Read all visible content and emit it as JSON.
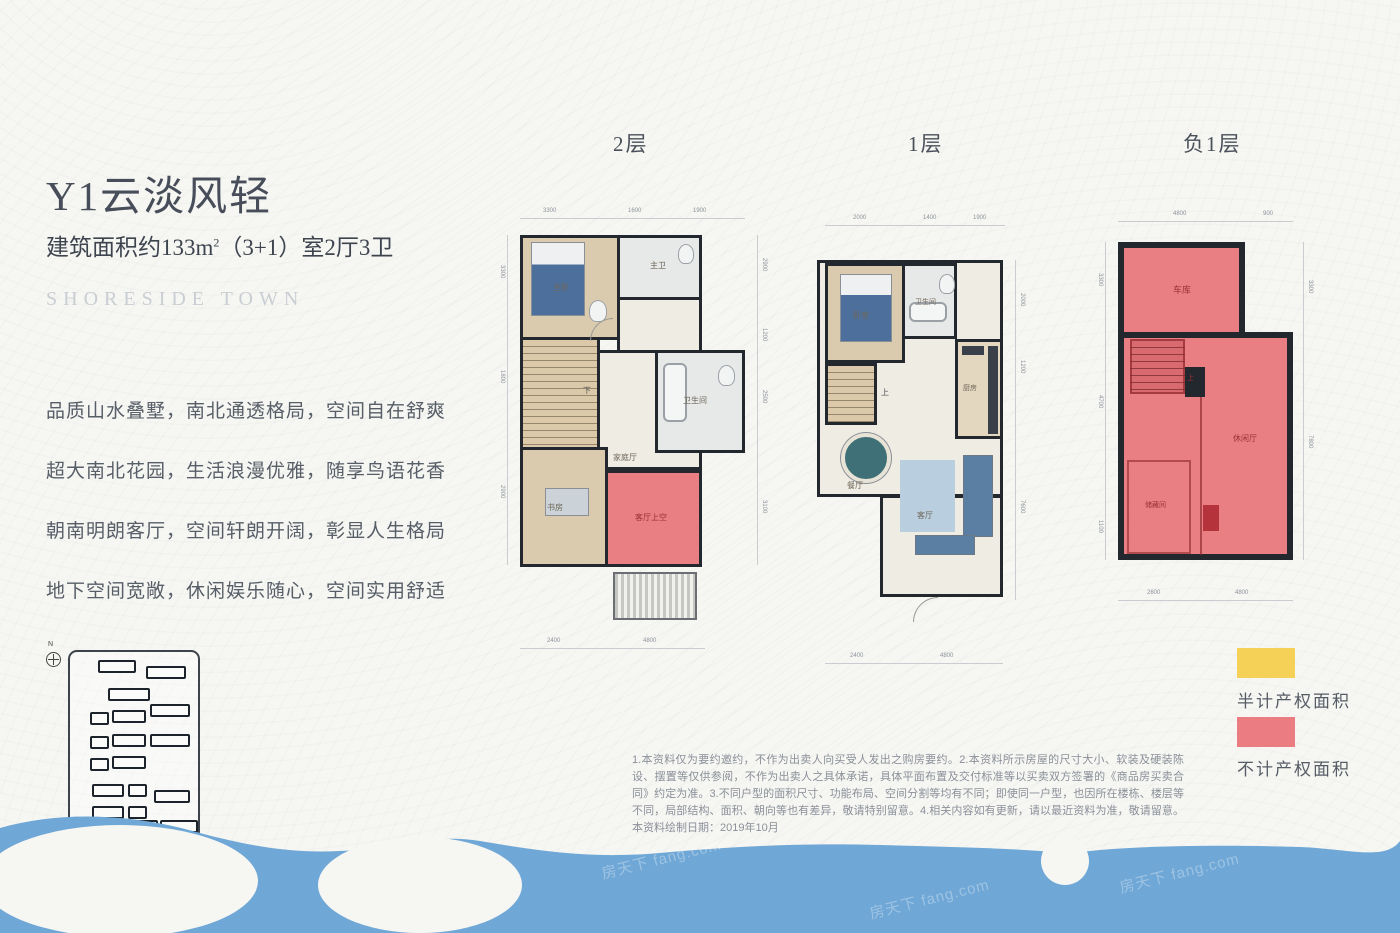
{
  "meta": {
    "brand": "SHORESIDE TOWN",
    "watermark": "房天下 fang.com",
    "compass_n": "N"
  },
  "info": {
    "title": "Y1云淡风轻",
    "area_prefix": "建筑面积约133m",
    "area_sup": "2",
    "area_suffix": "（3+1）室2厅3卫",
    "features": [
      "品质山水叠墅，南北通透格局，空间自在舒爽",
      "超大南北花园，生活浪漫优雅，随享鸟语花香",
      "朝南明朗客厅，空间轩朗开阔，彰显人生格局",
      "地下空间宽敞，休闲娱乐随心，空间实用舒适"
    ]
  },
  "plans": [
    {
      "label": "2层",
      "rooms": {
        "bedroom": "主卧",
        "bath1": "主卫",
        "bath2": "卫生间",
        "hall": "家庭厅",
        "study": "书房",
        "stairs": "下",
        "void": "客厅上空"
      },
      "dims": {
        "top": [
          "3300",
          "1600",
          "1900"
        ],
        "left": [
          "3300",
          "1800",
          "2900"
        ],
        "right": [
          "2900",
          "1200",
          "2500",
          "3100"
        ],
        "bottom": [
          "2400",
          "4800"
        ]
      }
    },
    {
      "label": "1层",
      "rooms": {
        "bedroom": "卧室",
        "bath": "卫生间",
        "kitchen": "厨房",
        "dining": "餐厅",
        "living": "客厅",
        "stairs": "上"
      },
      "dims": {
        "top": [
          "2000",
          "1400",
          "1900"
        ],
        "right": [
          "2000",
          "1200",
          "7600"
        ],
        "bottom": [
          "2400",
          "4800"
        ]
      }
    },
    {
      "label": "负1层",
      "rooms": {
        "garage": "车库",
        "rec": "休闲厅",
        "storage": "储藏间",
        "stairs": "上"
      },
      "dims": {
        "top": [
          "4800",
          "900"
        ],
        "left": [
          "3300",
          "4700",
          "1100"
        ],
        "right": [
          "3300",
          "7800"
        ],
        "bottom": [
          "2600",
          "4800"
        ]
      }
    }
  ],
  "legend": [
    {
      "color": "#f5d158",
      "label": "半计产权面积"
    },
    {
      "color": "#eb7d82",
      "label": "不计产权面积"
    }
  ],
  "disclaimer": "1.本资料仅为要约邀约，不作为出卖人向买受人发出之购房要约。2.本资料所示房屋的尺寸大小、软装及硬装陈设、摆置等仅供参阅，不作为出卖人之具体承诺，具体平面布置及交付标准等以买卖双方签署的《商品房买卖合同》约定为准。3.不同户型的面积尺寸、功能布局、空间分割等均有不同；即使同一户型，也因所在楼栋、楼层等不同，局部结构、面积、朝向等也有差异，敬请特别留意。4.相关内容如有更新，请以最近资料为准，敬请留意。本资料绘制日期：2019年10月"
}
